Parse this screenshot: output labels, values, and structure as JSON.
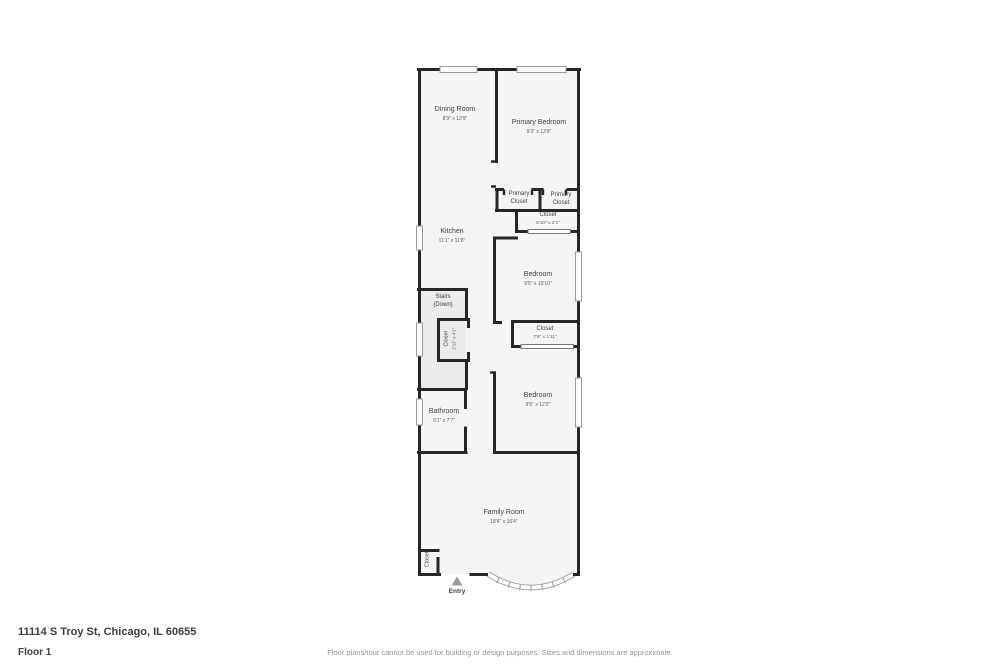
{
  "page": {
    "address": "11114 S Troy St, Chicago, IL 60655",
    "floor_label": "Floor 1",
    "disclaimer": "Floor plans/tour cannot be used for building or design purposes. Sizes and dimensions are approximate."
  },
  "colors": {
    "background": "#ffffff",
    "wall": "#262626",
    "floor": "#f5f5f6",
    "stairs_floor": "#ebebeb",
    "label_text": "#3f3f3f",
    "dims_text": "#5f5f5f",
    "window_border": "#9a9a9a",
    "entry_arrow": "#9b9b9b",
    "footer_text": "#3d3d3d",
    "disclaimer_text": "#939393"
  },
  "rooms": [
    {
      "name": "Dining Room",
      "sub": "8'9\" x 13'9\""
    },
    {
      "name": "Primary Bedroom",
      "sub": "9'3\" x 13'9\""
    },
    {
      "name": "Primary Closet",
      "sub": ""
    },
    {
      "name": "Primary Closet",
      "sub": ""
    },
    {
      "name": "Closet",
      "sub": "6'10\" x 2'1\""
    },
    {
      "name": "Kitchen",
      "sub": "11'1\" x 11'8\""
    },
    {
      "name": "Bedroom",
      "sub": "9'5\" x 10'10\""
    },
    {
      "name": "Stairs",
      "sub": "(Down)"
    },
    {
      "name": "Closet",
      "sub": "2'11\" x 4'1\""
    },
    {
      "name": "Closet",
      "sub": "7'6\" x 1'11\""
    },
    {
      "name": "Bathroom",
      "sub": "5'1\" x 7'7\""
    },
    {
      "name": "Bedroom",
      "sub": "9'5\" x 12'2\""
    },
    {
      "name": "Family Room",
      "sub": "18'4\" x 16'4\""
    },
    {
      "name": "Closet",
      "sub": ""
    }
  ],
  "entry": {
    "label": "Entry"
  }
}
